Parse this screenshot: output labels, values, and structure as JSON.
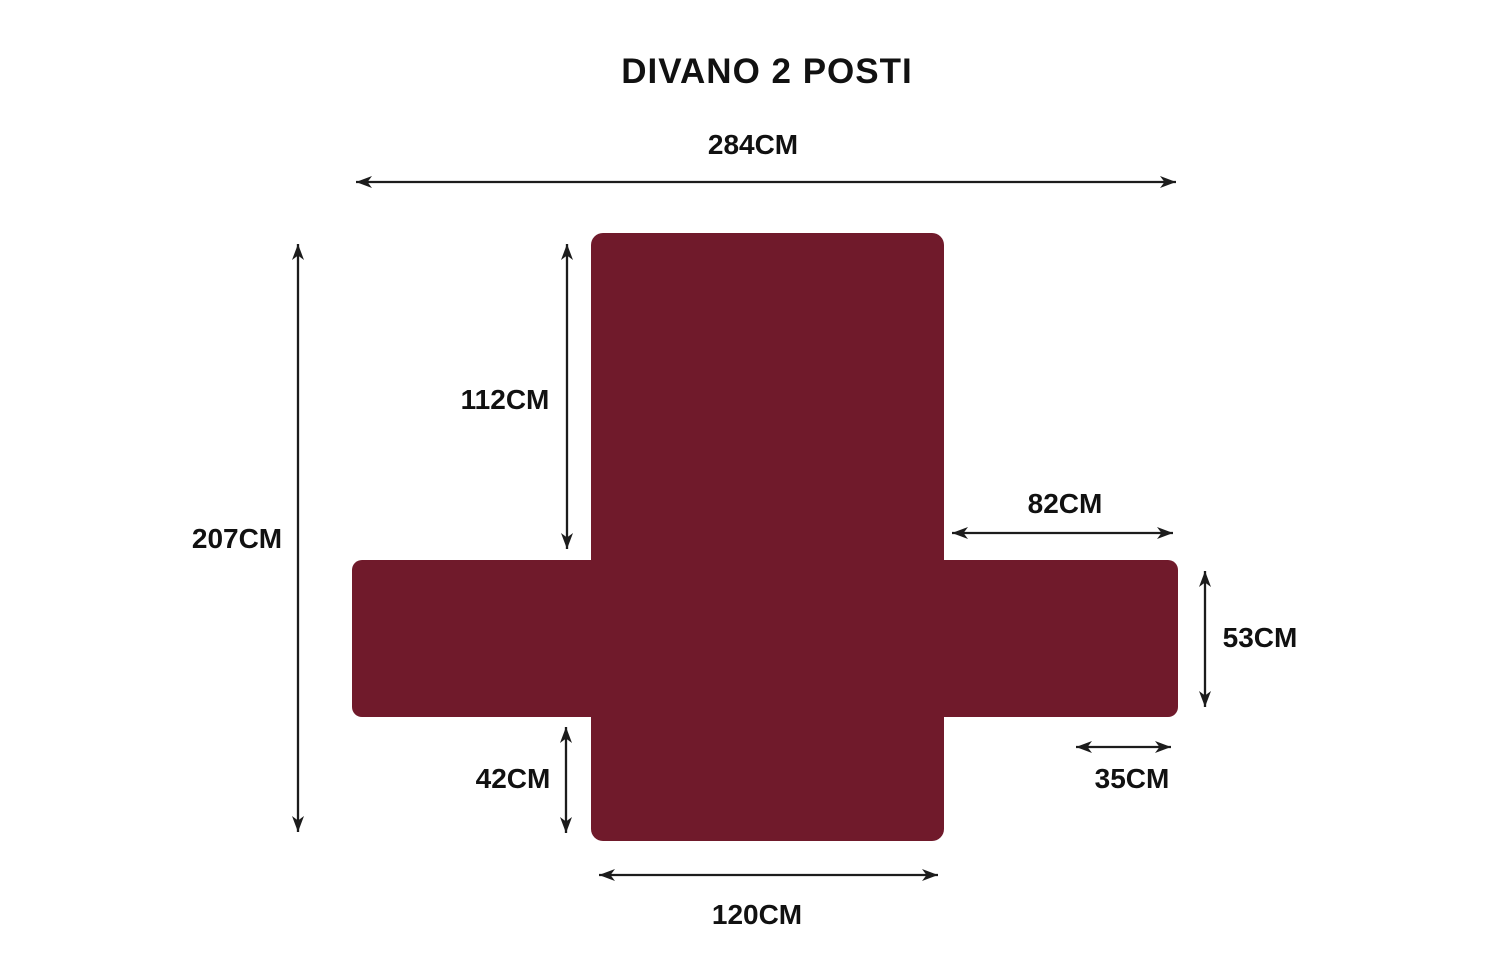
{
  "title": "DIVANO 2 POSTI",
  "colors": {
    "cover": "#701a2b",
    "line": "#1c1c1c",
    "text": "#111111",
    "background": "#ffffff"
  },
  "dimensions": {
    "total_width": "284CM",
    "total_height": "207CM",
    "backrest_height": "112CM",
    "arm_length": "82CM",
    "arm_width": "53CM",
    "flap_height": "42CM",
    "flap_width": "35CM",
    "seat_width": "120CM"
  }
}
